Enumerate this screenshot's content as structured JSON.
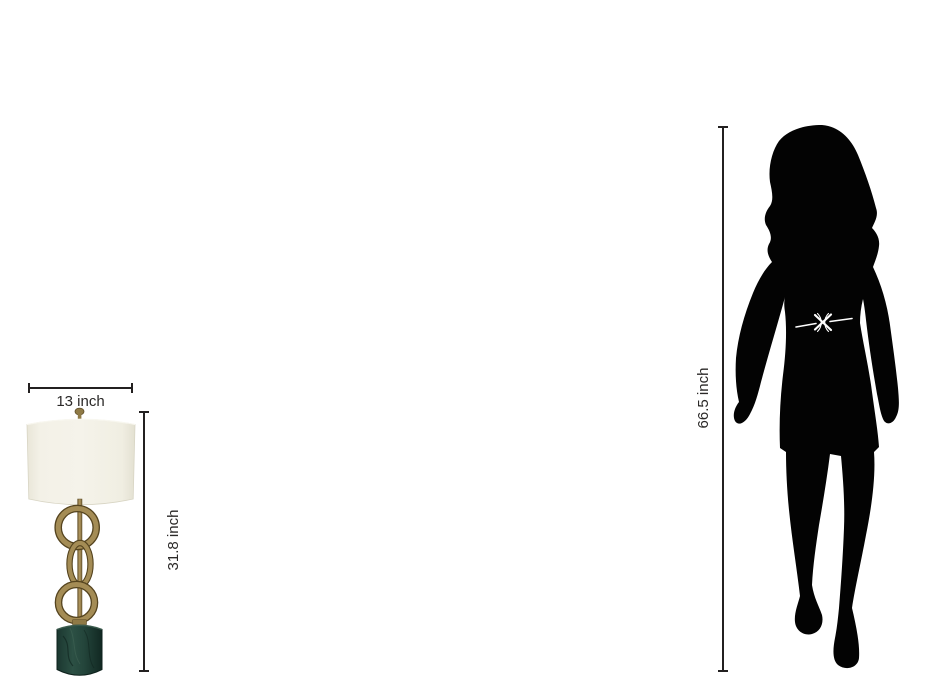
{
  "meta": {
    "description": "Product size comparison diagram: brass ring table lamp with green marble base next to adult woman silhouette"
  },
  "product": {
    "name": "table-lamp",
    "width_label": "13 inch",
    "height_label": "31.8 inch",
    "colors": {
      "shade": "#f2f0e6",
      "brass": "#a48c55",
      "brass_dark": "#55441f",
      "base_green": "#24453b",
      "base_green_dark": "#112822"
    }
  },
  "reference_figure": {
    "name": "adult-woman-silhouette",
    "height_label": "66.5 inch",
    "color": "#030303",
    "belt_color": "#ffffff"
  },
  "dimensions_style": {
    "line_color": "#232020",
    "label_color": "#2b2928"
  },
  "background": "#ffffff"
}
